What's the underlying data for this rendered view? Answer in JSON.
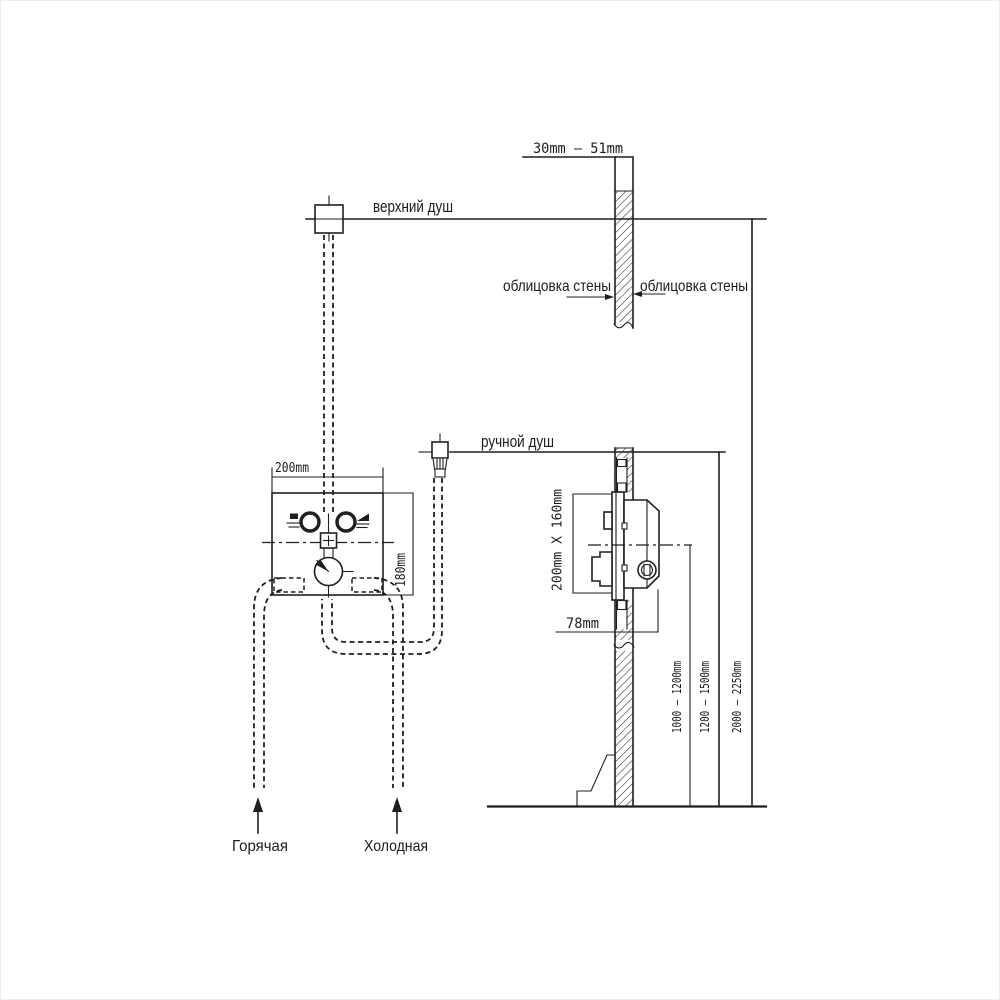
{
  "colors": {
    "background": "#ffffff",
    "ink": "#1c1c1c"
  },
  "front_view": {
    "upper_shower_label": "верхний душ",
    "hand_shower_label": "ручной душ",
    "mixer_width": "200mm",
    "mixer_height": "180mm",
    "hot_supply_label": "Горячая",
    "cold_supply_label": "Холодная"
  },
  "wall_section": {
    "tile_thickness_range": "30mm — 51mm",
    "cladding_left_label": "облицовка стены",
    "cladding_right_label": "облицовка стены",
    "rough_in_opening": "200mm X 160mm",
    "rough_in_depth": "78mm"
  },
  "mounting_heights": {
    "mixer_height_range": "1000 — 1200mm",
    "hand_shower_height_range": "1200 — 1500mm",
    "upper_shower_height_range": "2000 — 2250mm"
  }
}
